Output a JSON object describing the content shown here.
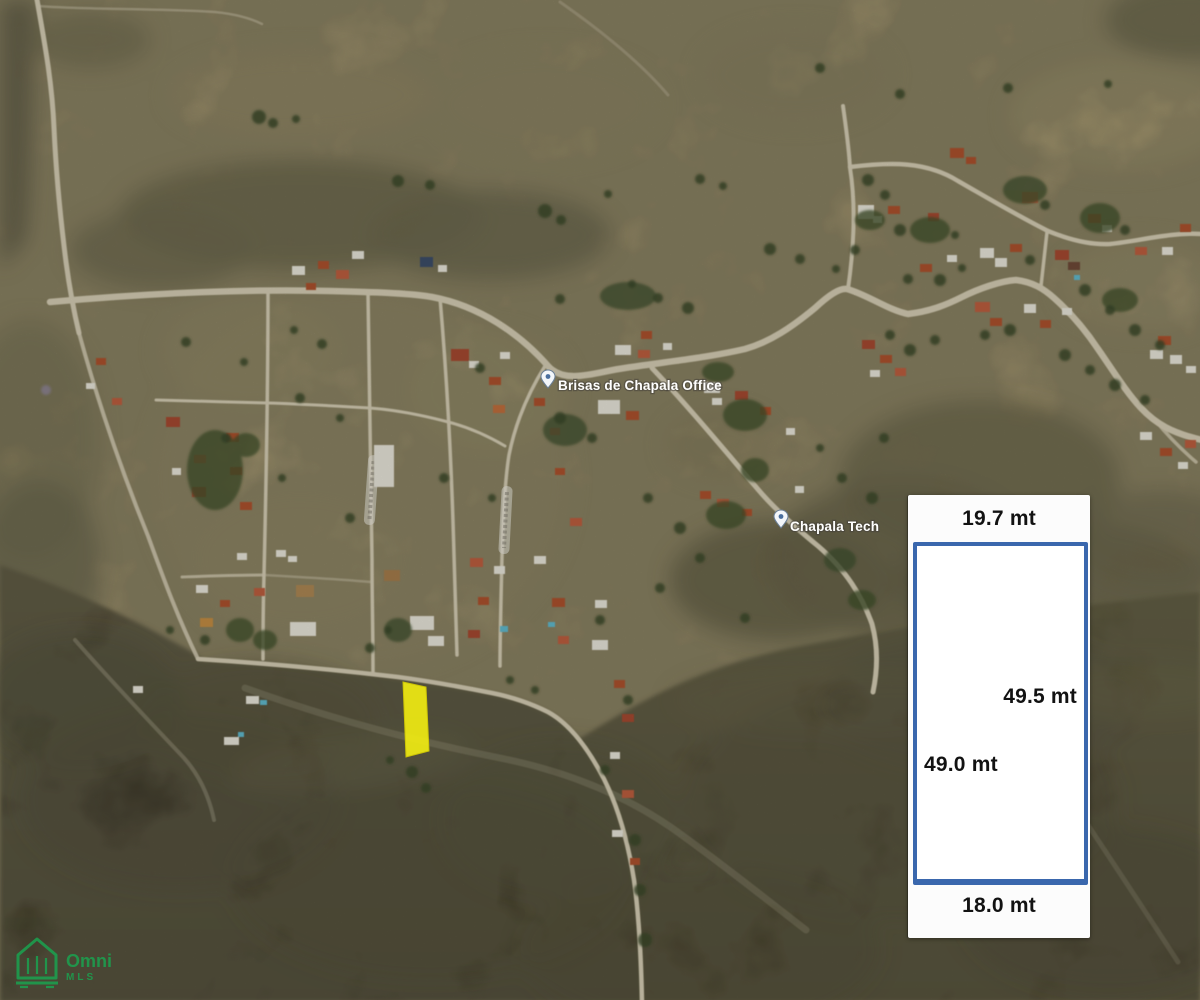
{
  "poi_labels": {
    "office": "Brisas de Chapala Office",
    "tech": "Chapala Tech"
  },
  "lot_diagram": {
    "top_width": "19.7 mt",
    "right_length": "49.5 mt",
    "left_length": "49.0 mt",
    "bottom_width": "18.0 mt",
    "border_color": "#3a67ad",
    "panel_background": "#fcfcfc"
  },
  "highlighted_lot": {
    "fill_color": "#f2ee12"
  },
  "watermark": {
    "brand": "Omni",
    "suffix": "MLS",
    "color": "#1ca04f"
  }
}
